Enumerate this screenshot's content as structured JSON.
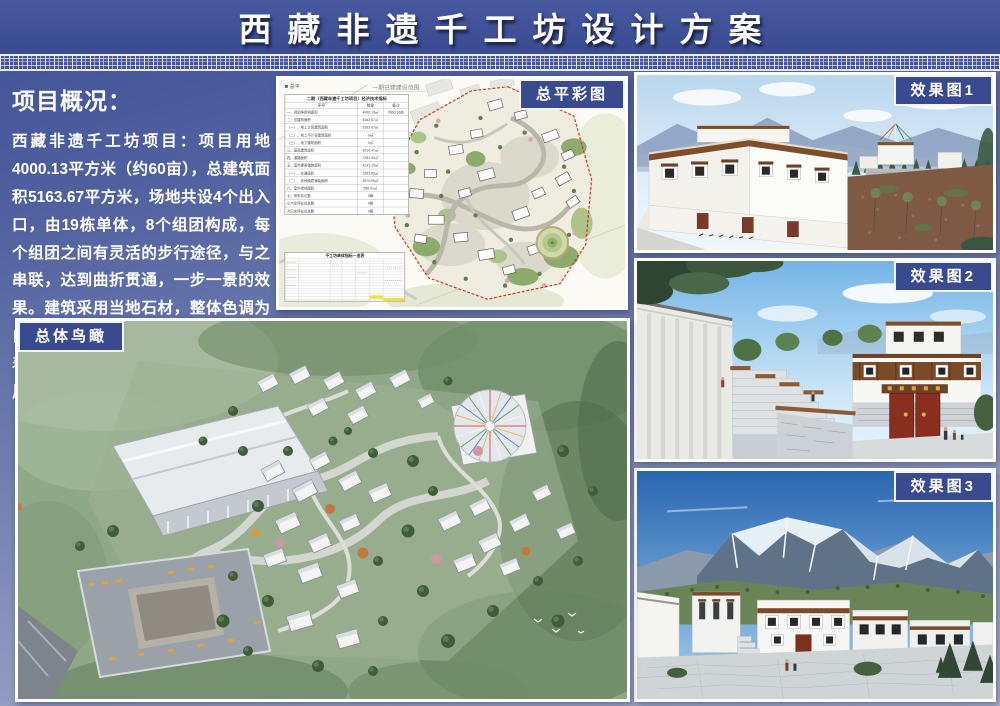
{
  "title": "西藏非遗千工坊设计方案",
  "overview": {
    "heading": "项目概况：",
    "body": "西藏非遗千工坊项目：项目用地4000.13平方米（约60亩），总建筑面积5163.67平方米，场地共设4个出入口，由19栋单体，8个组团构成，每个组团之间有灵活的步行途径，与之串联，达到曲折贯通，一步一景的效果。建筑采用当地石材，整体色调为白色，门窗样式为藏式传统样式，有着浓厚的藏式风味，符合片区的整体风貌。"
  },
  "panels": {
    "siteplan_label": "总平彩图",
    "render1_label": "效果图1",
    "render2_label": "效果图2",
    "render3_label": "效果图3",
    "aerial_label": "总体鸟瞰"
  },
  "siteplan": {
    "corner_note": "总平",
    "phase_note": "一期已建建设范围",
    "bottom_table_title": "千工坊单体指标一览表",
    "table": {
      "title": "二期（西藏非遗千工坊项目）经济技术指标",
      "headers": [
        "序号",
        "数量",
        "备注"
      ],
      "rows": [
        {
          "label": "一、规划净用地面积",
          "value": "4000.13㎡",
          "note": "约60.16亩"
        },
        {
          "label": "二、总建筑面积",
          "value": "5163.67㎡",
          "note": ""
        },
        {
          "label": "（一）、地上计容建筑面积",
          "value": "5163.67㎡",
          "note": ""
        },
        {
          "label": "（二）、地上不计容建筑面积",
          "value": "0㎡",
          "note": ""
        },
        {
          "label": "（三）、地下建筑面积",
          "value": "0㎡",
          "note": ""
        },
        {
          "label": "三、基底建筑面积",
          "value": "3214.47㎡",
          "note": ""
        },
        {
          "label": "四、道路面积",
          "value": "2781.34㎡",
          "note": ""
        },
        {
          "label": "五、室外硬质铺装面积",
          "value": "4233.15㎡",
          "note": ""
        },
        {
          "label": "（一）、车道面积",
          "value": "1353.82㎡",
          "note": ""
        },
        {
          "label": "（二）、其他硬质铺装面积",
          "value": "2879.90㎡",
          "note": ""
        },
        {
          "label": "六、室外绿地面积",
          "value": "556.91㎡",
          "note": ""
        },
        {
          "label": "七、停车总位数",
          "value": "0辆",
          "note": ""
        },
        {
          "label": "小汽车停车位总数",
          "value": "0辆",
          "note": ""
        },
        {
          "label": "大巴车停车位总数",
          "value": "0辆",
          "note": ""
        }
      ]
    },
    "colors": {
      "boundary": "#cc3322",
      "greenery": "#8cab6c",
      "road": "#b9b6aa"
    }
  },
  "theme": {
    "band_blue": "#3a4a8e",
    "title_blue": "#3c4e96",
    "text_white": "#ffffff"
  }
}
